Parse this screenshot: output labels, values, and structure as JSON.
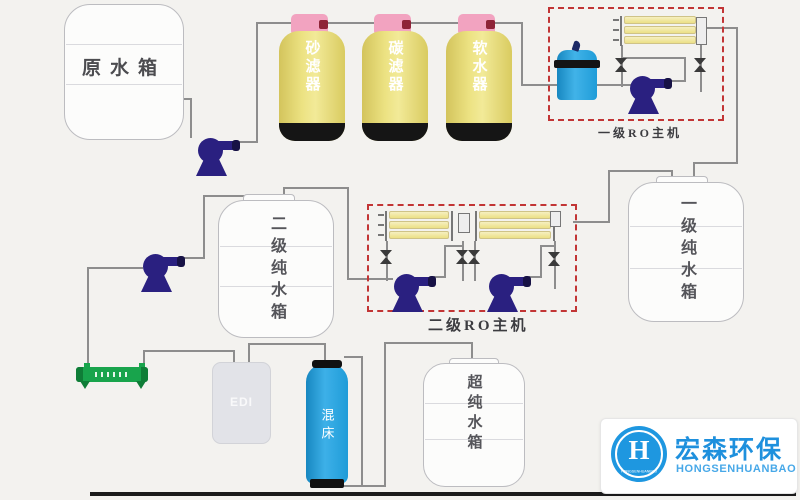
{
  "labels": {
    "raw_tank": "原水箱",
    "sand_filter": "砂滤器",
    "carbon_filter": "碳滤器",
    "softener": "软水器",
    "ro1": "一级RO主机",
    "ro2": "二级RO主机",
    "stage2_tank": "二级纯水箱",
    "stage1_tank": "一级纯水箱",
    "ultra_tank": "超纯水箱",
    "edi": "EDI",
    "mixed_bed": "混床"
  },
  "logo": {
    "brand": "宏森环保",
    "romanized": "HONGSENHUANBAO",
    "monogram": "H",
    "ring_text": "HONGSENHUANBAO"
  },
  "colors": {
    "background": "#f3f2ef",
    "pipe": "#8d8d8d",
    "pump_navy": "#2a2080",
    "ro_box_dashed_red": "#c23535",
    "filter_yellow": "#e9df7d",
    "filter_cap_pink": "#f2a3c0",
    "cap_valve_dark_red": "#8e2437",
    "blue_vessel": "#2aa3dd",
    "uv_green": "#18a44c",
    "logo_blue": "#1e97e0"
  },
  "icons": {
    "pump-icon": "navy centrifugal pump with outlet arm",
    "valve-icon": "hourglass/bowtie manual valve",
    "membrane-icon": "stack of 3 yellow RO membrane housings",
    "uv-sterilizer-icon": "green horizontal UV sterilizer tube",
    "precision-filter-icon": "blue cartridge filter with black band"
  }
}
